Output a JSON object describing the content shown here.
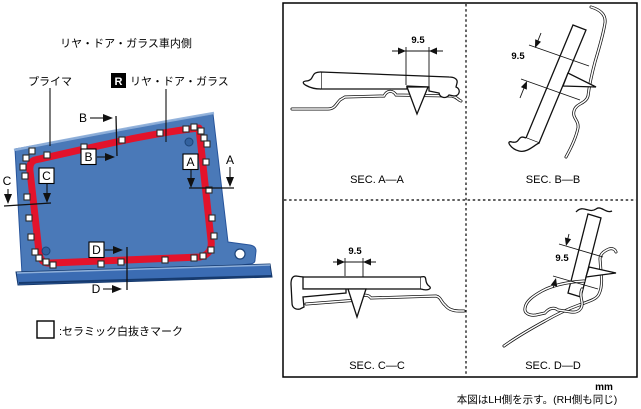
{
  "left_panel": {
    "title": "リヤ・ドア・ガラス車内側",
    "primer_label": "プライマ",
    "glass_badge": "R",
    "glass_label": "リヤ・ドア・ガラス",
    "legend_text": ":セラミック白抜きマーク",
    "section_letters": {
      "A": "A",
      "B": "B",
      "C": "C",
      "D": "D"
    }
  },
  "sections_panel": {
    "sections": [
      {
        "label": "SEC. A—A",
        "dimension": "9.5"
      },
      {
        "label": "SEC. B—B",
        "dimension": "9.5"
      },
      {
        "label": "SEC. C—C",
        "dimension": "9.5"
      },
      {
        "label": "SEC. D—D",
        "dimension": "9.5"
      }
    ],
    "unit": "mm"
  },
  "footer_note": "本図はLH側を示す。(RH側も同じ)",
  "colors": {
    "glass_blue": "#4a79b8",
    "glass_blue_light": "#8fb0da",
    "glass_blue_dark": "#27549b",
    "primer_red": "#e3132b"
  }
}
